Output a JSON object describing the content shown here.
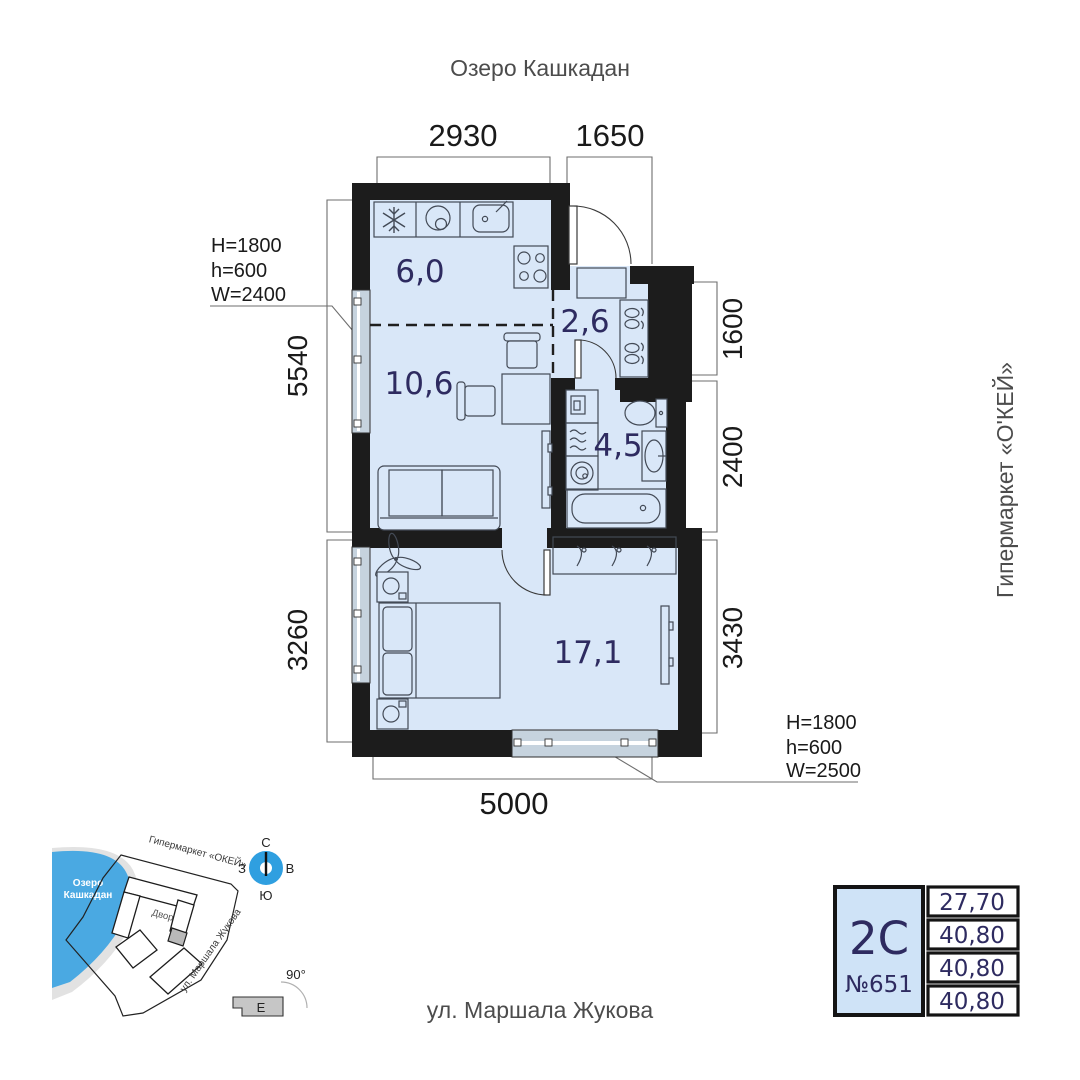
{
  "labels": {
    "lake": "Озеро Кашкадан",
    "hypermarket": "Гипермаркет «О'КЕЙ»",
    "street": "ул. Маршала Жукова"
  },
  "dims": {
    "top1": "2930",
    "top2": "1650",
    "left1": "5540",
    "left2": "3260",
    "right1": "1600",
    "right2": "2400",
    "right3": "3430",
    "bottom": "5000"
  },
  "annotations": {
    "left": {
      "l1": "H=1800",
      "l2": "h=600",
      "l3": "W=2400"
    },
    "right": {
      "l1": "H=1800",
      "l2": "h=600",
      "l3": "W=2500"
    }
  },
  "rooms": {
    "kitchen": "6,0",
    "hall": "2,6",
    "living": "10,6",
    "bath": "4,5",
    "bedroom": "17,1"
  },
  "minimap": {
    "lake_line1": "Озеро",
    "lake_line2": "Кашкадан",
    "hypermarket": "Гипермаркет «ОКЕЙ»",
    "street": "ул. Маршала Жукова",
    "courtyard": "Двор",
    "compass": {
      "n": "С",
      "s": "Ю",
      "w": "З",
      "e": "В"
    },
    "angle": "90°",
    "section": "Е"
  },
  "card": {
    "type": "2С",
    "number": "№651",
    "values": [
      "27,70",
      "40,80",
      "40,80",
      "40,80"
    ]
  },
  "colors": {
    "room_fill": "#d9e7f8",
    "wall": "#1c1c1c",
    "accent_navy": "#2e2b60",
    "compass_blue": "#2f9fe0",
    "lake_blue": "#4aa9e2",
    "card_fill": "#cfe3f7"
  }
}
